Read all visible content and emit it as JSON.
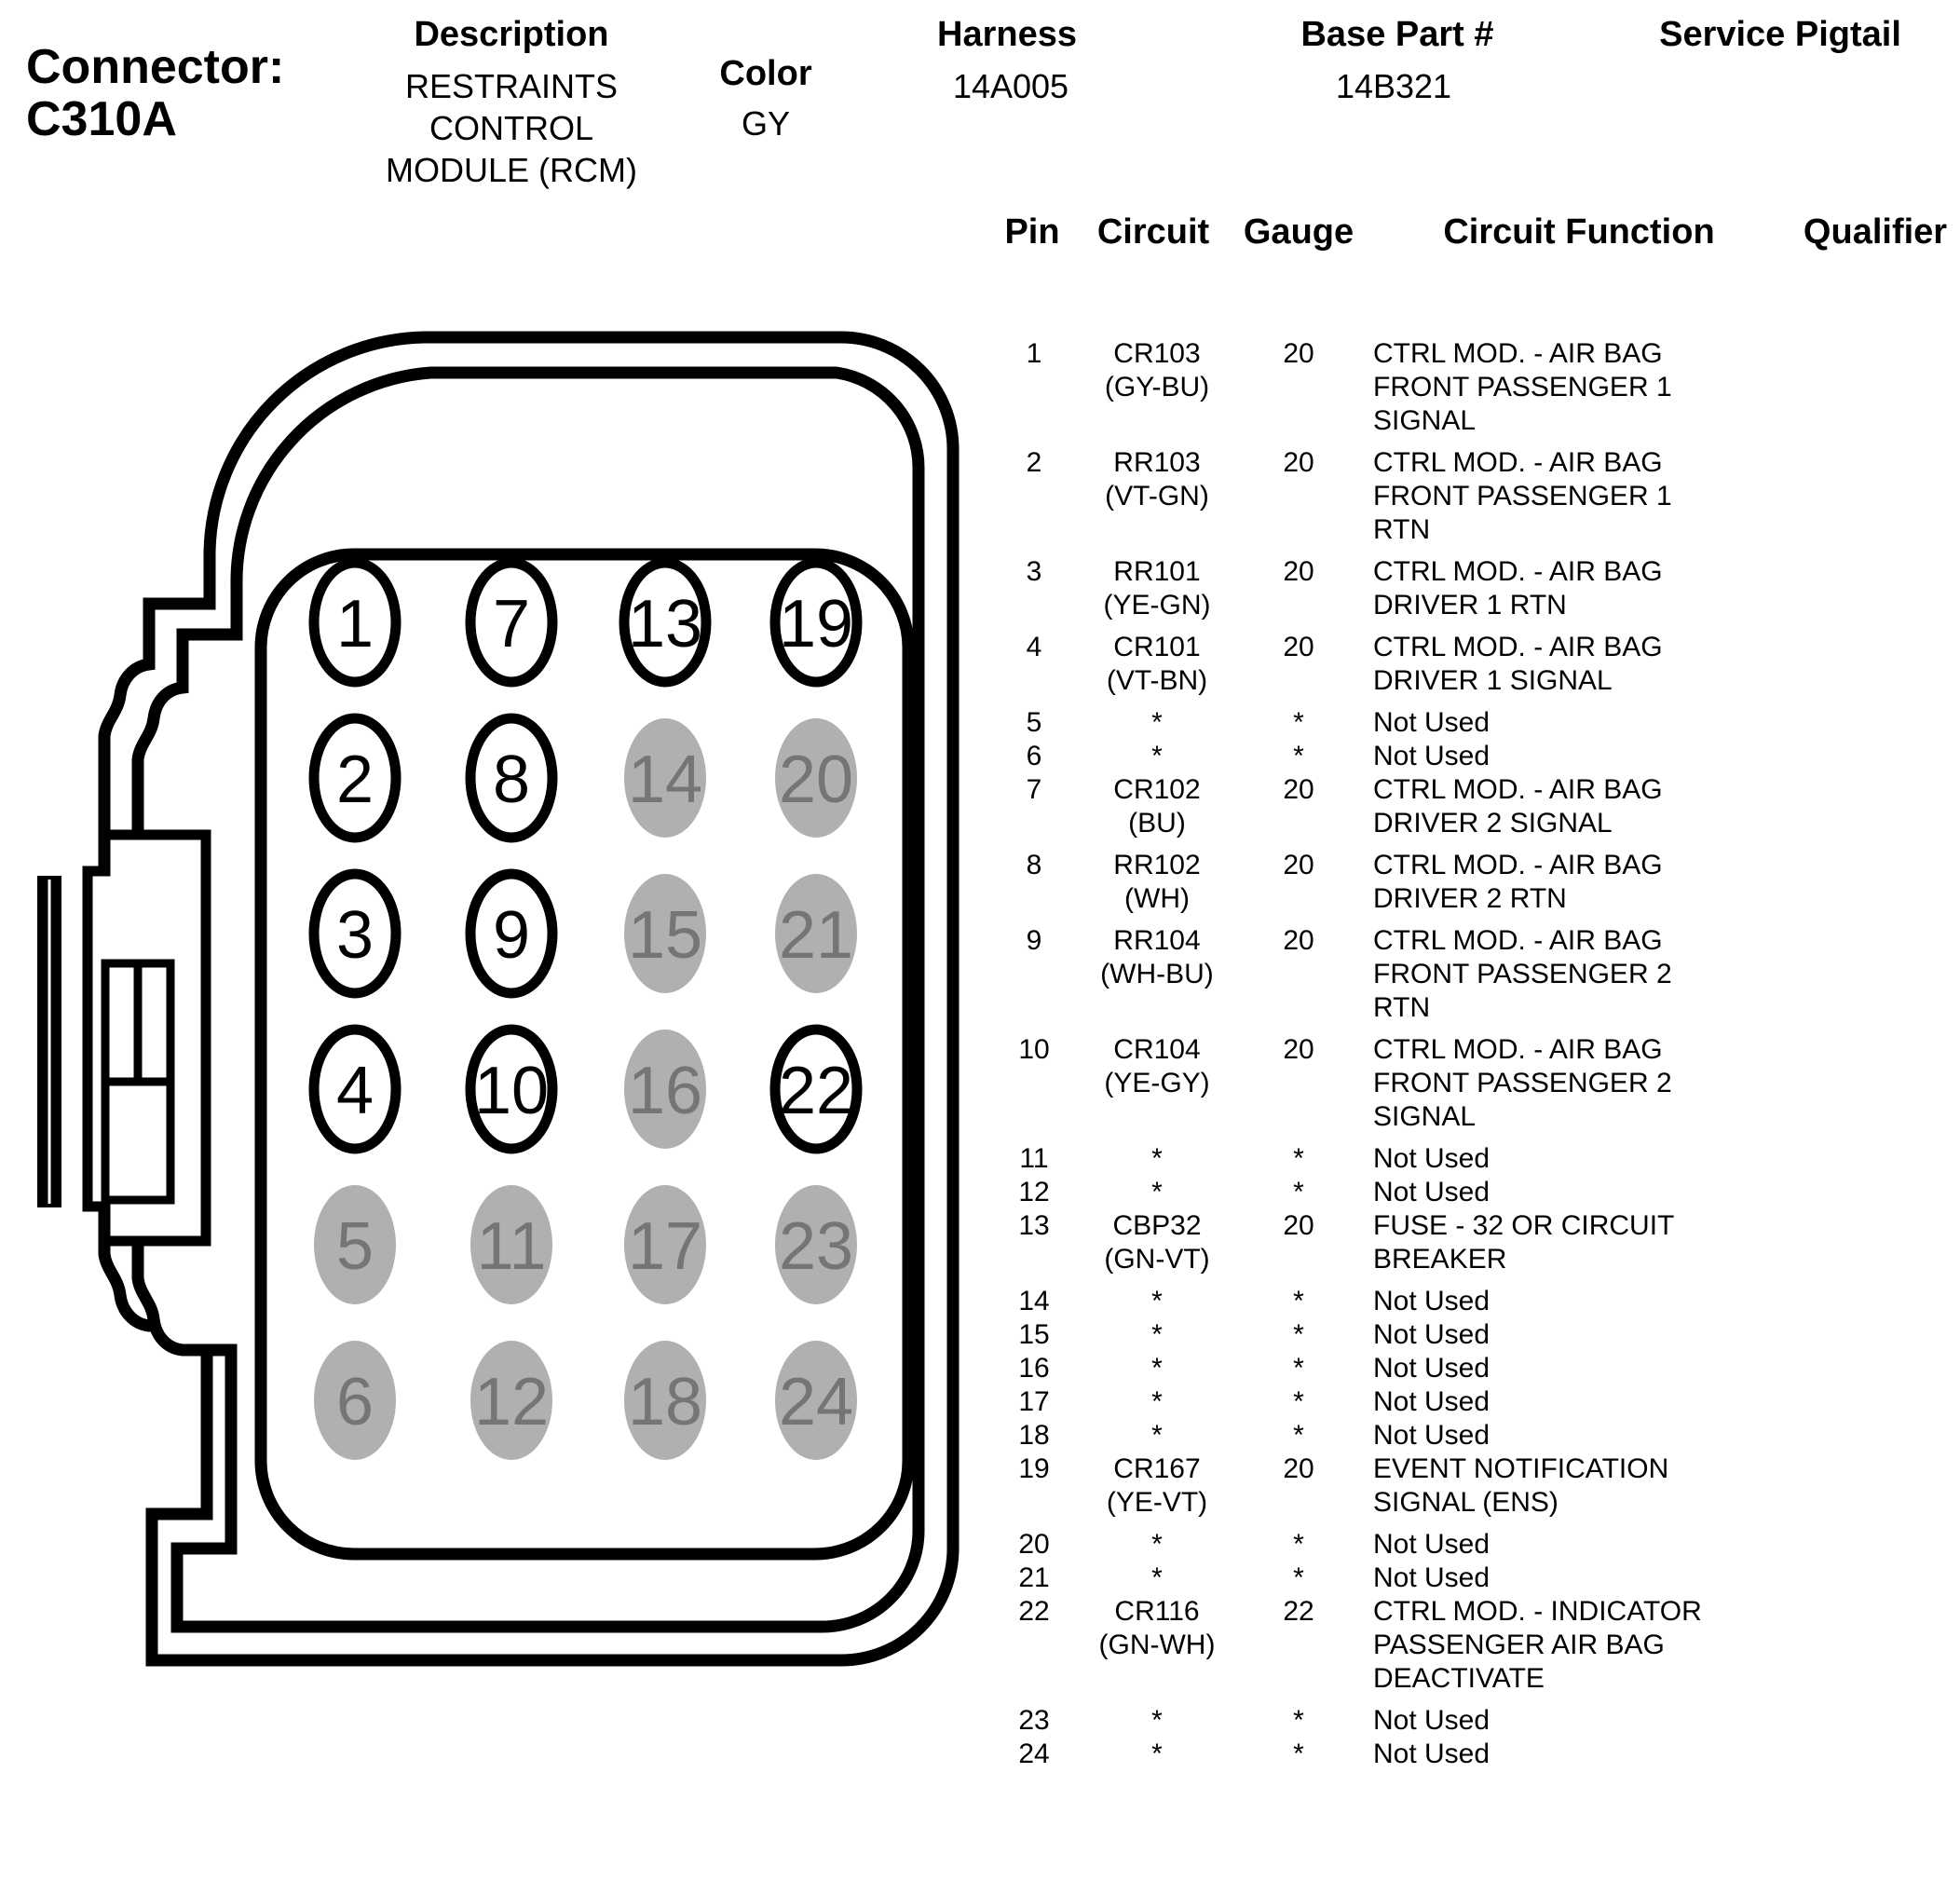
{
  "header": {
    "connector_label": "Connector:",
    "connector_id": "C310A",
    "description_label": "Description",
    "description_value": "RESTRAINTS CONTROL MODULE (RCM)",
    "color_label": "Color",
    "color_value": "GY",
    "harness_label": "Harness",
    "harness_value": "14A005",
    "base_part_label": "Base Part #",
    "base_part_value": "14B321",
    "service_pigtail_label": "Service Pigtail"
  },
  "connector": {
    "colors": {
      "line": "#000000",
      "body_fill": "#ffffff",
      "unused_fill": "#b0b0b0",
      "unused_text": "#757575",
      "used_text": "#000000"
    },
    "pins": [
      {
        "n": "1",
        "used": true
      },
      {
        "n": "2",
        "used": true
      },
      {
        "n": "3",
        "used": true
      },
      {
        "n": "4",
        "used": true
      },
      {
        "n": "5",
        "used": false
      },
      {
        "n": "6",
        "used": false
      },
      {
        "n": "7",
        "used": true
      },
      {
        "n": "8",
        "used": true
      },
      {
        "n": "9",
        "used": true
      },
      {
        "n": "10",
        "used": true
      },
      {
        "n": "11",
        "used": false
      },
      {
        "n": "12",
        "used": false
      },
      {
        "n": "13",
        "used": true
      },
      {
        "n": "14",
        "used": false
      },
      {
        "n": "15",
        "used": false
      },
      {
        "n": "16",
        "used": false
      },
      {
        "n": "17",
        "used": false
      },
      {
        "n": "18",
        "used": false
      },
      {
        "n": "19",
        "used": true
      },
      {
        "n": "20",
        "used": false
      },
      {
        "n": "21",
        "used": false
      },
      {
        "n": "22",
        "used": true
      },
      {
        "n": "23",
        "used": false
      },
      {
        "n": "24",
        "used": false
      }
    ]
  },
  "table": {
    "headers": [
      "Pin",
      "Circuit",
      "Gauge",
      "Circuit Function",
      "Qualifier"
    ],
    "rows": [
      {
        "pin": "1",
        "circuit": "CR103",
        "circuit_color": "(GY-BU)",
        "gauge": "20",
        "function": "CTRL MOD. - AIR BAG FRONT PASSENGER 1 SIGNAL",
        "qualifier": ""
      },
      {
        "pin": "2",
        "circuit": "RR103",
        "circuit_color": "(VT-GN)",
        "gauge": "20",
        "function": "CTRL MOD. - AIR BAG FRONT PASSENGER 1 RTN",
        "qualifier": ""
      },
      {
        "pin": "3",
        "circuit": "RR101",
        "circuit_color": "(YE-GN)",
        "gauge": "20",
        "function": "CTRL MOD. - AIR BAG DRIVER 1 RTN",
        "qualifier": ""
      },
      {
        "pin": "4",
        "circuit": "CR101",
        "circuit_color": "(VT-BN)",
        "gauge": "20",
        "function": "CTRL MOD. - AIR BAG DRIVER 1 SIGNAL",
        "qualifier": ""
      },
      {
        "pin": "5",
        "circuit": "*",
        "circuit_color": "",
        "gauge": "*",
        "function": "Not Used",
        "qualifier": ""
      },
      {
        "pin": "6",
        "circuit": "*",
        "circuit_color": "",
        "gauge": "*",
        "function": "Not Used",
        "qualifier": ""
      },
      {
        "pin": "7",
        "circuit": "CR102",
        "circuit_color": "(BU)",
        "gauge": "20",
        "function": "CTRL MOD. - AIR BAG DRIVER 2 SIGNAL",
        "qualifier": ""
      },
      {
        "pin": "8",
        "circuit": "RR102",
        "circuit_color": "(WH)",
        "gauge": "20",
        "function": "CTRL MOD. - AIR BAG DRIVER 2 RTN",
        "qualifier": ""
      },
      {
        "pin": "9",
        "circuit": "RR104",
        "circuit_color": "(WH-BU)",
        "gauge": "20",
        "function": "CTRL MOD. - AIR BAG FRONT PASSENGER 2 RTN",
        "qualifier": ""
      },
      {
        "pin": "10",
        "circuit": "CR104",
        "circuit_color": "(YE-GY)",
        "gauge": "20",
        "function": "CTRL MOD. - AIR BAG FRONT PASSENGER 2 SIGNAL",
        "qualifier": ""
      },
      {
        "pin": "11",
        "circuit": "*",
        "circuit_color": "",
        "gauge": "*",
        "function": "Not Used",
        "qualifier": ""
      },
      {
        "pin": "12",
        "circuit": "*",
        "circuit_color": "",
        "gauge": "*",
        "function": "Not Used",
        "qualifier": ""
      },
      {
        "pin": "13",
        "circuit": "CBP32",
        "circuit_color": "(GN-VT)",
        "gauge": "20",
        "function": "FUSE - 32 OR CIRCUIT BREAKER",
        "qualifier": ""
      },
      {
        "pin": "14",
        "circuit": "*",
        "circuit_color": "",
        "gauge": "*",
        "function": "Not Used",
        "qualifier": ""
      },
      {
        "pin": "15",
        "circuit": "*",
        "circuit_color": "",
        "gauge": "*",
        "function": "Not Used",
        "qualifier": ""
      },
      {
        "pin": "16",
        "circuit": "*",
        "circuit_color": "",
        "gauge": "*",
        "function": "Not Used",
        "qualifier": ""
      },
      {
        "pin": "17",
        "circuit": "*",
        "circuit_color": "",
        "gauge": "*",
        "function": "Not Used",
        "qualifier": ""
      },
      {
        "pin": "18",
        "circuit": "*",
        "circuit_color": "",
        "gauge": "*",
        "function": "Not Used",
        "qualifier": ""
      },
      {
        "pin": "19",
        "circuit": "CR167",
        "circuit_color": "(YE-VT)",
        "gauge": "20",
        "function": "EVENT NOTIFICATION SIGNAL (ENS)",
        "qualifier": ""
      },
      {
        "pin": "20",
        "circuit": "*",
        "circuit_color": "",
        "gauge": "*",
        "function": "Not Used",
        "qualifier": ""
      },
      {
        "pin": "21",
        "circuit": "*",
        "circuit_color": "",
        "gauge": "*",
        "function": "Not Used",
        "qualifier": ""
      },
      {
        "pin": "22",
        "circuit": "CR116",
        "circuit_color": "(GN-WH)",
        "gauge": "22",
        "function": "CTRL MOD. - INDICATOR PASSENGER AIR BAG DEACTIVATE",
        "qualifier": ""
      },
      {
        "pin": "23",
        "circuit": "*",
        "circuit_color": "",
        "gauge": "*",
        "function": "Not Used",
        "qualifier": ""
      },
      {
        "pin": "24",
        "circuit": "*",
        "circuit_color": "",
        "gauge": "*",
        "function": "Not Used",
        "qualifier": ""
      }
    ]
  }
}
